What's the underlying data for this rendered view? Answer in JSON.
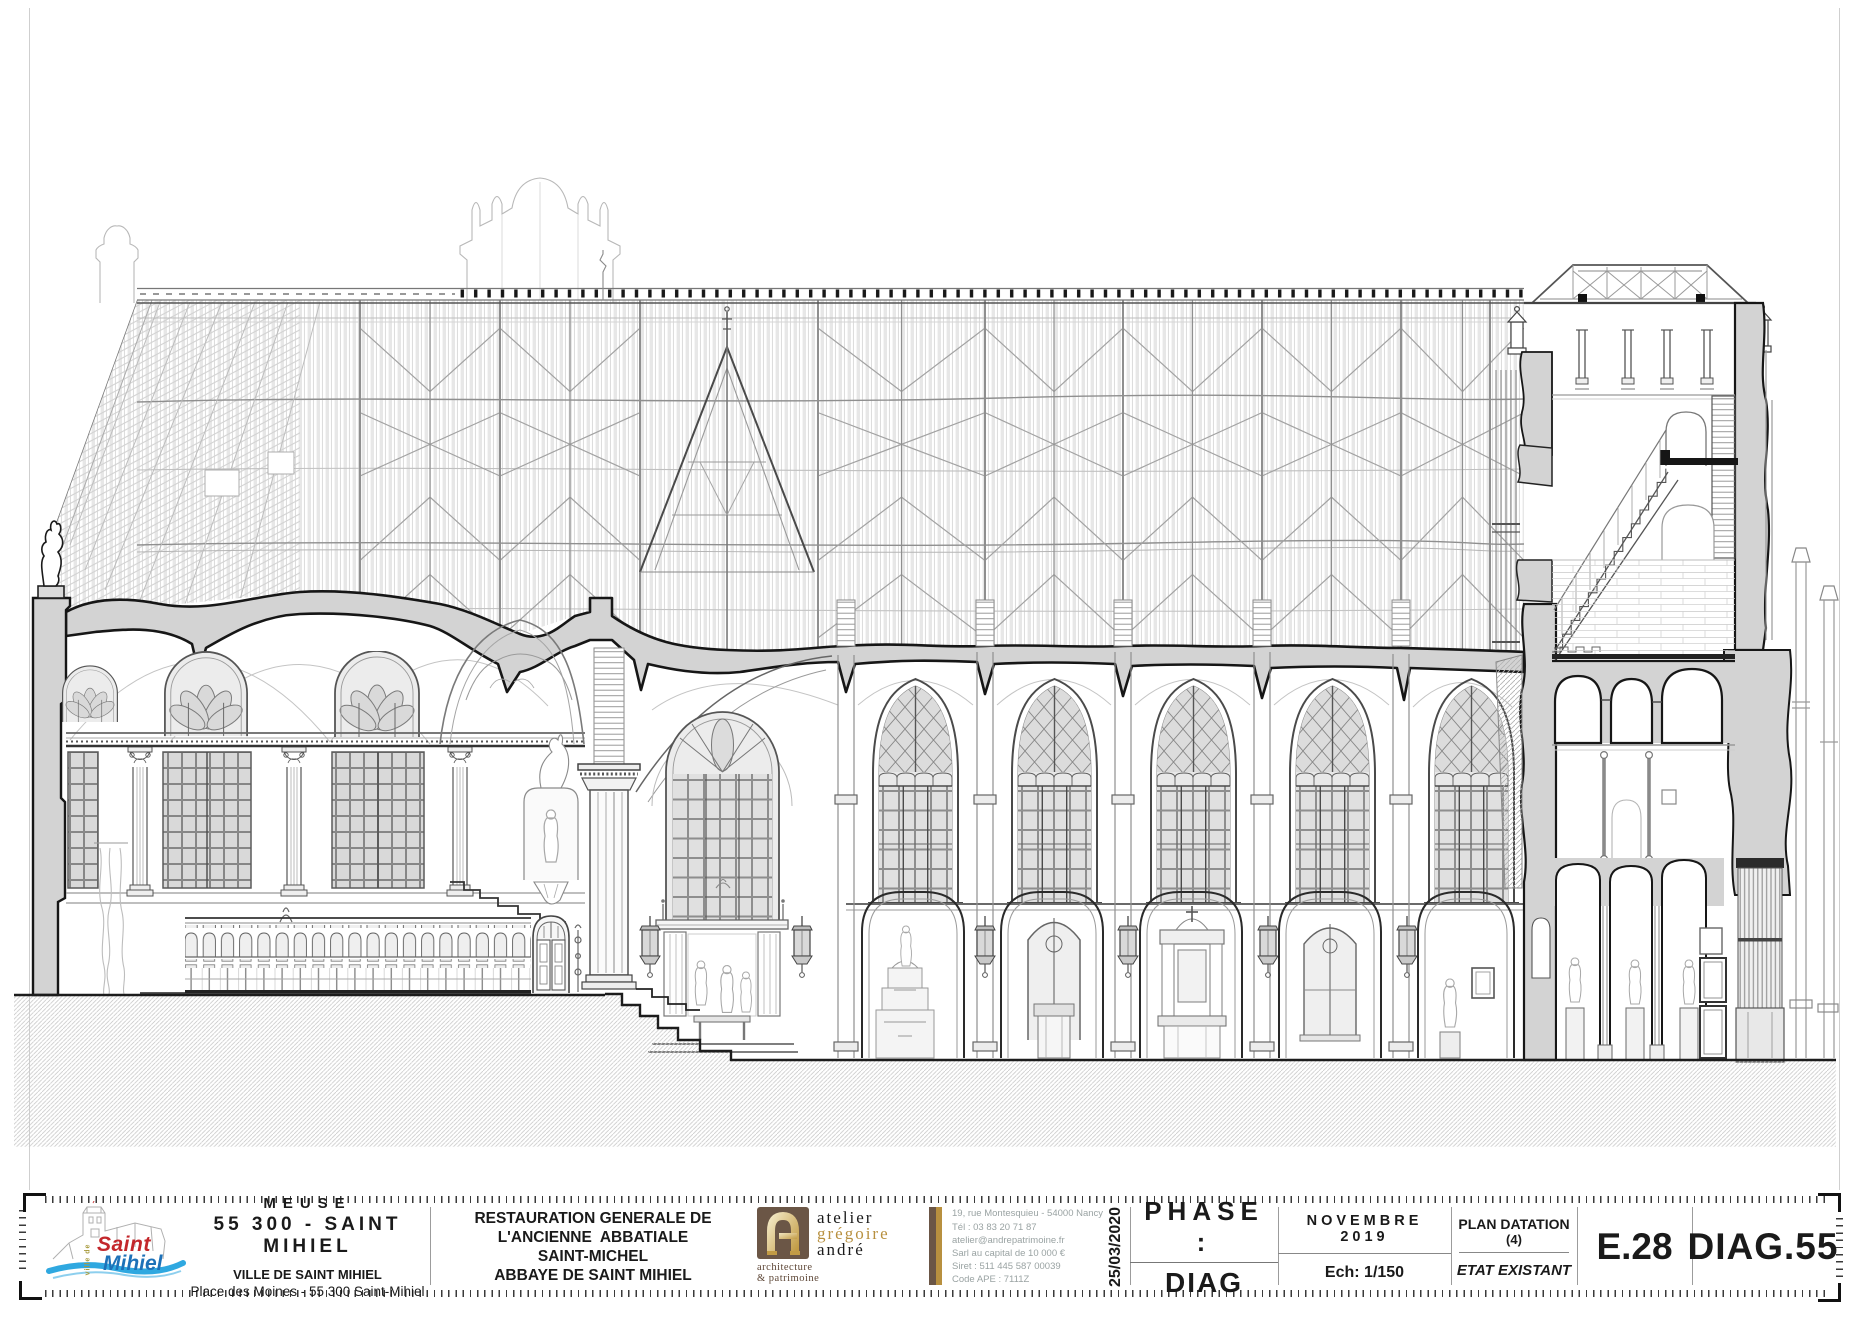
{
  "theme": {
    "accent-red": "#c3272b",
    "accent-blue": "#1d71b8",
    "wave-blue": "#2fa8e0",
    "olive": "#a79a3c",
    "brown": "#6b5646",
    "gold": "#b8903f",
    "dark-brown": "#5d4636",
    "gray-text": "#9aa3a3",
    "poche-gray": "#d3d3d3",
    "cut-line": "#161616"
  },
  "title_block": {
    "client": {
      "region": "MEUSE",
      "city_line": "55 300 - SAINT MIHIEL",
      "org": "VILLE DE SAINT MIHIEL",
      "address": "Place des Moines - 55 300 Saint-Mihiel",
      "logo": {
        "word1": "Saint",
        "word2": "Mihiel",
        "vertical": "ville de"
      }
    },
    "project": {
      "line1": "RESTAURATION GENERALE DE",
      "line2": "L'ANCIENNE  ABBATIALE",
      "line3": "SAINT-MICHEL",
      "line4": "ABBAYE DE SAINT MIHIEL"
    },
    "architect": {
      "word1": "atelier",
      "word2": "grégoire",
      "word3": "andré",
      "tag1": "architecture",
      "tag2": "& patrimoine",
      "contact1": "19, rue Montesquieu - 54000 Nancy",
      "contact2": "Tél : 03 83 20 71 87",
      "contact3": "atelier@andrepatrimoine.fr",
      "contact4": "Sarl au capital de 10 000 €",
      "contact5": "Siret : 511 445 587 00039",
      "contact6": "Code APE : 7111Z"
    },
    "date_stamp": "25/03/2020",
    "phase": {
      "label": "PHASE :",
      "value": "DIAG"
    },
    "issue": {
      "date": "NOVEMBRE 2019",
      "scale": "Ech: 1/150"
    },
    "datation": {
      "title": "PLAN DATATION",
      "index": "(4)",
      "status": "ETAT EXISTANT"
    },
    "sheet_index": "E.28",
    "sheet_number": "DIAG.55"
  }
}
